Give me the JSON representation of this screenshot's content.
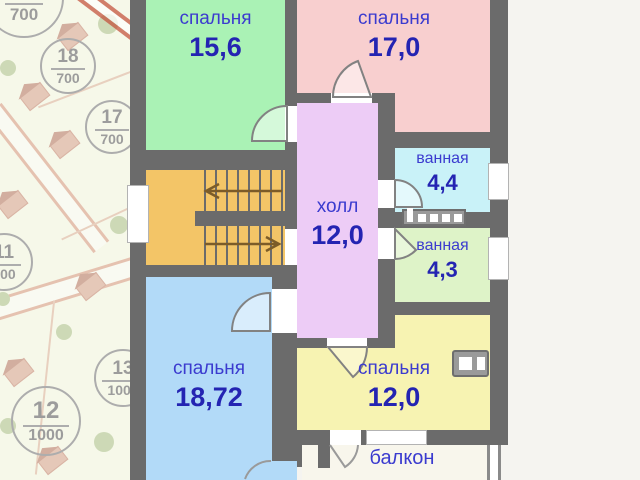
{
  "plan": {
    "rooms": {
      "bedroom_top_left": {
        "name": "спальня",
        "area": "15,6"
      },
      "bedroom_top_right": {
        "name": "спальня",
        "area": "17,0"
      },
      "hall": {
        "name": "холл",
        "area": "12,0"
      },
      "bathroom_upper": {
        "name": "ванная",
        "area": "4,4"
      },
      "bathroom_lower": {
        "name": "ванная",
        "area": "4,3"
      },
      "bedroom_bottom_left": {
        "name": "спальня",
        "area": "18,72"
      },
      "bedroom_bottom_right": {
        "name": "спальня",
        "area": "12,0"
      },
      "balcony": {
        "name": "балкон"
      }
    },
    "fixtures": [
      "staircase-up-arrow",
      "staircase-down-arrow",
      "shelf-fixture",
      "washing-machine-fixture",
      "balcony-railing"
    ],
    "colors": {
      "wall": "#6b6b6b",
      "bedroom_top_left": "#aaf2b5",
      "bedroom_top_right": "#f8cfcf",
      "hall": "#edccf6",
      "bathroom_upper": "#c9f2f8",
      "bathroom_lower": "#def3c8",
      "bedroom_bottom_left": "#b2daf8",
      "bedroom_bottom_right": "#f7f3b2",
      "stairs": "#f3c567",
      "balcony": "#f8f6ec",
      "label_text": "#3b3bcf",
      "area_text": "#2424b2"
    }
  },
  "site_map": {
    "plots": [
      {
        "number": "21",
        "size": "700"
      },
      {
        "number": "18",
        "size": "700"
      },
      {
        "number": "17",
        "size": "700"
      },
      {
        "number": "11",
        "size": "700"
      },
      {
        "number": "13",
        "size": "1000"
      },
      {
        "number": "12",
        "size": "1000"
      }
    ]
  }
}
